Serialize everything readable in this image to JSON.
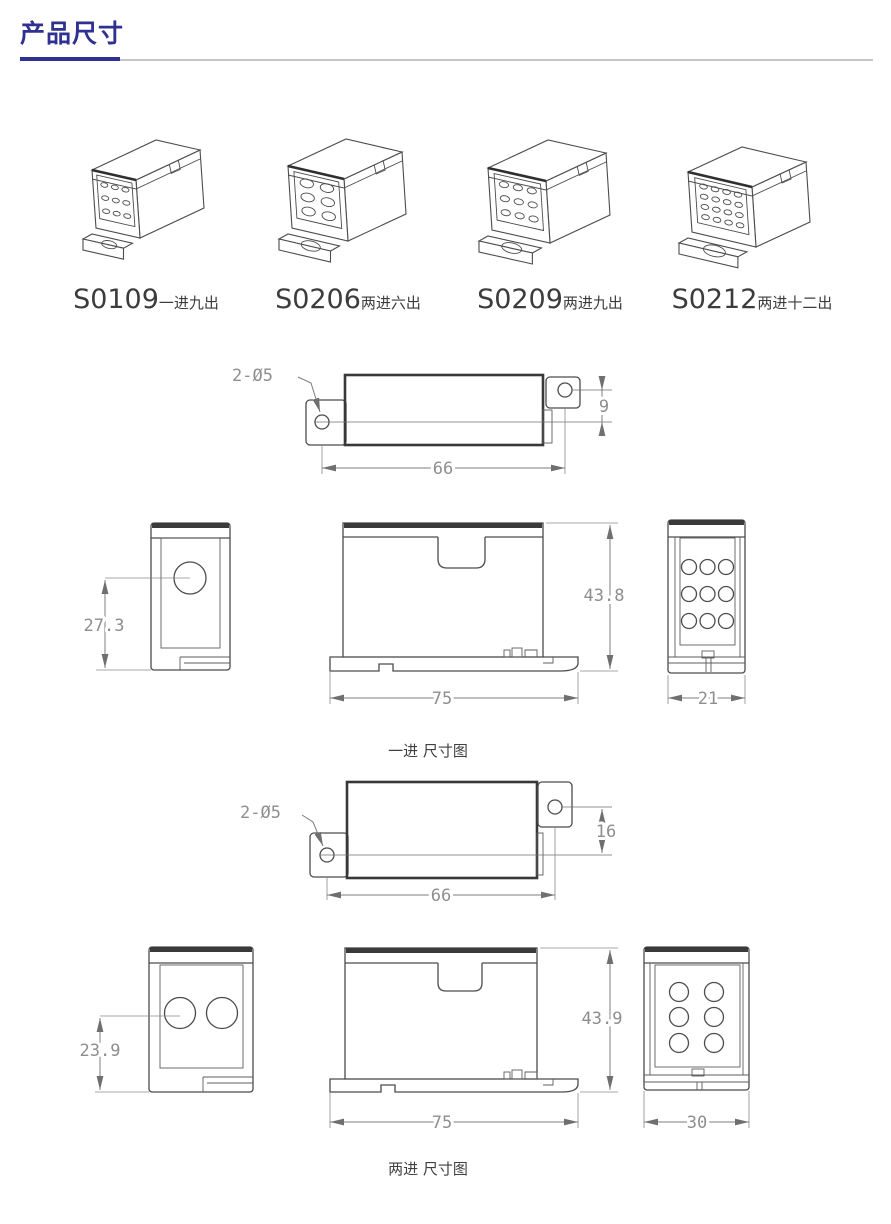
{
  "page": {
    "title": "产品尺寸"
  },
  "theme": {
    "accent": "#2e3192",
    "rule_gray": "#c6c6c6",
    "line_color": "#4c4c4c",
    "dim_text_color": "#8e8e8e"
  },
  "products": [
    {
      "model": "S0109",
      "desc": "一进九出",
      "holes": {
        "cols": 3,
        "rows": 3
      }
    },
    {
      "model": "S0206",
      "desc": "两进六出",
      "holes": {
        "cols": 2,
        "rows": 3
      }
    },
    {
      "model": "S0209",
      "desc": "两进九出",
      "holes": {
        "cols": 3,
        "rows": 3
      }
    },
    {
      "model": "S0212",
      "desc": "两进十二出",
      "holes": {
        "cols": 4,
        "rows": 4
      }
    }
  ],
  "diagram_one_in": {
    "caption": "一进 尺寸图",
    "top_view": {
      "hole_label": "2-Ø5",
      "length": "66",
      "offset": "9"
    },
    "side_view": {
      "hole_height": "27.3",
      "input_holes": 1
    },
    "front_view": {
      "width": "75",
      "height": "43.8"
    },
    "end_view": {
      "width": "21",
      "hole_grid": "3x3"
    }
  },
  "diagram_two_in": {
    "caption": "两进 尺寸图",
    "top_view": {
      "hole_label": "2-Ø5",
      "length": "66",
      "offset": "16"
    },
    "side_view": {
      "hole_height": "23.9",
      "input_holes": 2
    },
    "front_view": {
      "width": "75",
      "height": "43.9"
    },
    "end_view": {
      "width": "30",
      "hole_grid": "2x3"
    }
  }
}
